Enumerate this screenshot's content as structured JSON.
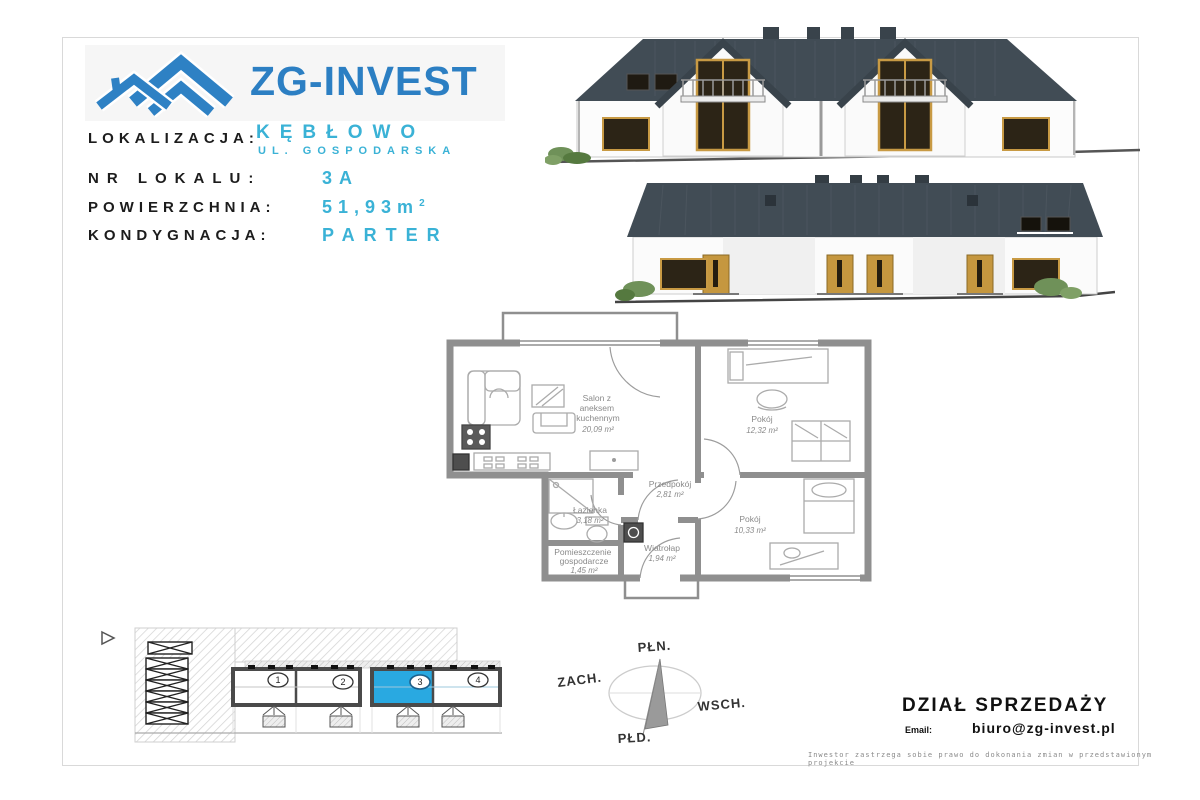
{
  "page": {
    "brand": "ZG-INVEST",
    "header": {
      "lokalizacja_label": "LOKALIZACJA:",
      "lokalizacja_value": "KĘBŁOWO",
      "street": "UL. GOSPODARSKA",
      "nr_lokalu_label": "NR LOKALU:",
      "nr_lokalu_value": "3A",
      "powierzchnia_label": "POWIERZCHNIA:",
      "powierzchnia_value": "51,93",
      "powierzchnia_unit": "m",
      "powierzchnia_sup": "2",
      "kondygnacja_label": "KONDYGNACJA:",
      "kondygnacja_value": "PARTER"
    }
  },
  "floorplan": {
    "rooms": {
      "salon": {
        "name_lines": [
          "Salon z",
          "aneksem",
          "kuchennym"
        ],
        "area": "20,09 m²"
      },
      "pokoj_gorny": {
        "name_lines": [
          "Pokój"
        ],
        "area": "12,32 m²"
      },
      "przedpokoj": {
        "name_lines": [
          "Przedpokój"
        ],
        "area": "2,81 m²"
      },
      "lazienka": {
        "name_lines": [
          "Łazienka"
        ],
        "area": "3,18 m²"
      },
      "pom_gospodarcze": {
        "name_lines": [
          "Pomieszczenie",
          "gospodarcze"
        ],
        "area": "1,45 m²"
      },
      "wiatrolap": {
        "name_lines": [
          "Wiatrołap"
        ],
        "area": "1,94 m²"
      },
      "pokoj_dolny": {
        "name_lines": [
          "Pokój"
        ],
        "area": "10,33 m²"
      }
    }
  },
  "siteplan": {
    "units": [
      "1",
      "2",
      "3",
      "4"
    ],
    "highlighted_unit": "3"
  },
  "compass": {
    "north": "PŁN.",
    "east": "WSCH.",
    "south": "PŁD.",
    "west": "ZACH."
  },
  "sales": {
    "title": "DZIAŁ SPRZEDAŻY",
    "email_label": "Email:",
    "email": "biuro@zg-invest.pl"
  },
  "disclaimer": "Inwestor zastrzega sobie prawo do dokonania zmian w przedstawionym projekcie",
  "colors": {
    "accent_blue": "#2e81c4",
    "value_cyan": "#3ab2d6",
    "roof_dark": "#414c55",
    "unit_highlight": "#29a9e1"
  }
}
